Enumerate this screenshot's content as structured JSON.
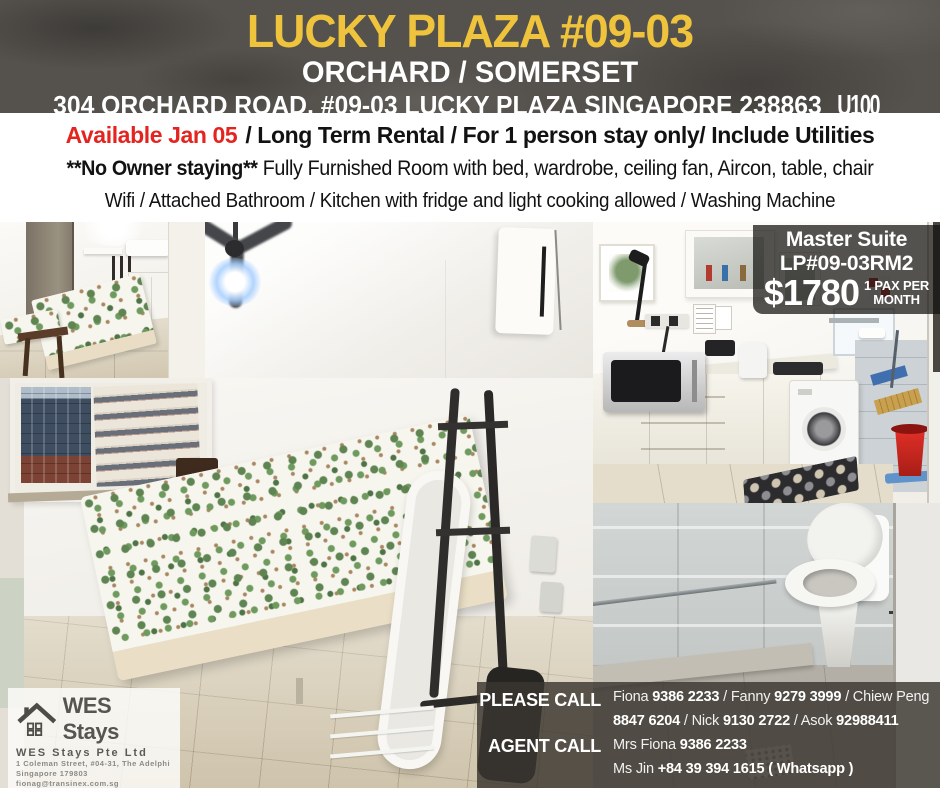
{
  "header": {
    "title": "LUCKY PLAZA #09-03",
    "subtitle": "ORCHARD / SOMERSET",
    "address": "304 ORCHARD ROAD, #09-03 LUCKY PLAZA SINGAPORE 238863",
    "unit_code": "U100"
  },
  "listing": {
    "available": "Available Jan 05",
    "line1_rest": "/ Long Term Rental / For 1 person stay only/ Include Utilities",
    "no_owner": "**No Owner staying**",
    "line2_rest": " Fully Furnished Room with bed, wardrobe, ceiling fan,  Aircon, table, chair",
    "line3": "Wifi / Attached Bathroom / Kitchen with fridge and light cooking allowed / Washing Machine"
  },
  "price_card": {
    "room_name": "Master Suite",
    "room_code": "LP#09-03RM2",
    "price": "$1780",
    "pax_line1": "1 PAX PER",
    "pax_line2": "MONTH"
  },
  "agency": {
    "logo_icon": "house-icon",
    "logo_text": "WES Stays",
    "company": "WES Stays Pte Ltd",
    "address1": "1 Coleman Street, #04-31, The Adelphi",
    "address2": "Singapore 179803",
    "email": "fionag@transinex.com.sg",
    "reg": "63363733/ 4/ 5/ UEN 202104588Z"
  },
  "contacts": {
    "please_call_label": "PLEASE CALL",
    "agent_call_label": "AGENT CALL",
    "line1": [
      {
        "text": "Fiona "
      },
      {
        "text": "9386 2233",
        "bold": true
      },
      {
        "text": " / Fanny "
      },
      {
        "text": "9279 3999",
        "bold": true
      },
      {
        "text": " / Chiew Peng"
      }
    ],
    "line2": [
      {
        "text": "8847 6204",
        "bold": true
      },
      {
        "text": " / Nick  "
      },
      {
        "text": "9130 2722",
        "bold": true
      },
      {
        "text": " / Asok "
      },
      {
        "text": "92988411",
        "bold": true
      }
    ],
    "line3": [
      {
        "text": "Mrs Fiona  "
      },
      {
        "text": "9386 2233",
        "bold": true
      }
    ],
    "line4": [
      {
        "text": "Ms Jin "
      },
      {
        "text": "+84 39 394 1615 ( Whatsapp )",
        "bold": true
      }
    ]
  },
  "colors": {
    "accent_yellow": "#efc43c",
    "alert_red": "#e3241f",
    "header_bg": "#55524d",
    "overlay_dark": "rgba(58,54,48,0.82)"
  }
}
